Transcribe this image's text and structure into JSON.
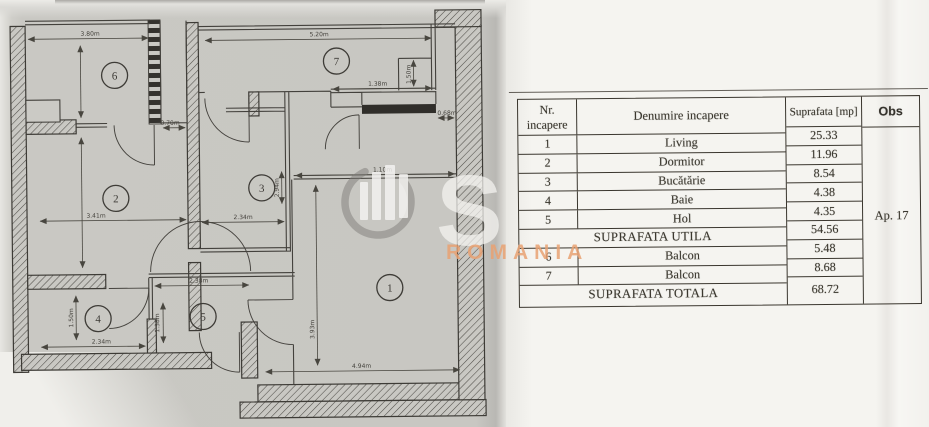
{
  "plan": {
    "rooms": [
      {
        "n": "6",
        "x": 116,
        "y": 74
      },
      {
        "n": "7",
        "x": 338,
        "y": 62
      },
      {
        "n": "2",
        "x": 116,
        "y": 197
      },
      {
        "n": "3",
        "x": 262,
        "y": 188
      },
      {
        "n": "4",
        "x": 97,
        "y": 317
      },
      {
        "n": "5",
        "x": 202,
        "y": 316
      },
      {
        "n": "1",
        "x": 389,
        "y": 289
      }
    ],
    "dims": [
      {
        "t": "3.80m",
        "x": 92,
        "y": 34,
        "r": 0
      },
      {
        "t": "0.70m",
        "x": 171,
        "y": 124,
        "r": 0
      },
      {
        "t": "5.20m",
        "x": 321,
        "y": 37,
        "r": 0
      },
      {
        "t": "1.50m",
        "x": 412,
        "y": 76,
        "r": -90
      },
      {
        "t": "1.38m",
        "x": 379,
        "y": 87,
        "r": 0
      },
      {
        "t": "0.68m",
        "x": 448,
        "y": 117,
        "r": 0
      },
      {
        "t": "1.10m",
        "x": 383,
        "y": 173,
        "r": 0
      },
      {
        "t": "3.41m",
        "x": 96,
        "y": 216,
        "r": 0
      },
      {
        "t": "2.34m",
        "x": 243,
        "y": 219,
        "r": 0
      },
      {
        "t": "2.94m",
        "x": 279,
        "y": 188,
        "r": -90
      },
      {
        "t": "2.34m",
        "x": 100,
        "y": 342,
        "r": 0
      },
      {
        "t": "1.50m",
        "x": 72,
        "y": 316,
        "r": -90
      },
      {
        "t": "2.38m",
        "x": 198,
        "y": 282,
        "r": 0
      },
      {
        "t": "1.38m",
        "x": 158,
        "y": 322,
        "r": -90
      },
      {
        "t": "4.94m",
        "x": 360,
        "y": 369,
        "r": 0
      },
      {
        "t": "3.93m",
        "x": 313,
        "y": 330,
        "r": -90
      }
    ]
  },
  "table": {
    "headers": {
      "nr_line1": "Nr.",
      "nr_line2": "incapere",
      "name": "Denumire incapere",
      "area": "Suprafata [mp]",
      "obs": "Obs"
    },
    "rows": [
      {
        "nr": "1",
        "name": "Living",
        "area": "25.33"
      },
      {
        "nr": "2",
        "name": "Dormitor",
        "area": "11.96"
      },
      {
        "nr": "3",
        "name": "Bucătărie",
        "area": "8.54"
      },
      {
        "nr": "4",
        "name": "Baie",
        "area": "4.38"
      },
      {
        "nr": "5",
        "name": "Hol",
        "area": "4.35"
      },
      {
        "merged": "SUPRAFATA UTILA",
        "area": "54.56"
      },
      {
        "nr": "6",
        "name": "Balcon",
        "area": "5.48"
      },
      {
        "nr": "7",
        "name": "Balcon",
        "area": "8.68"
      },
      {
        "merged": "SUPRAFATA TOTALA",
        "area": "68.72"
      }
    ],
    "obs_value": "Ap. 17"
  },
  "watermark": {
    "letter": "S",
    "text": "ROMANIA",
    "ring_color": "#7d7b78",
    "bar_color": "#f5f4f2",
    "letter_color": "#f6f5f2",
    "text_color": "#e9a273"
  }
}
